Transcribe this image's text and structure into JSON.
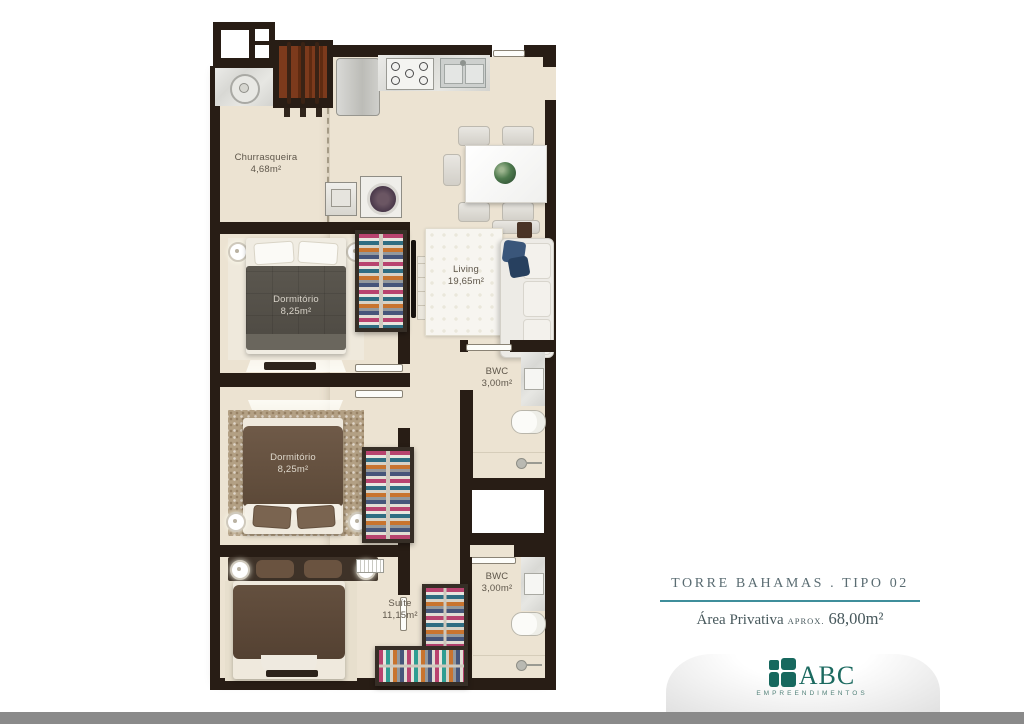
{
  "plan": {
    "rooms": {
      "churrasqueira": {
        "name": "Churrasqueira",
        "area": "4,68m²"
      },
      "living": {
        "name": "Living",
        "area": "19,65m²"
      },
      "dorm1": {
        "name": "Dormitório",
        "area": "8,25m²"
      },
      "dorm2": {
        "name": "Dormitório",
        "area": "8,25m²"
      },
      "bwc1": {
        "name": "BWC",
        "area": "3,00m²"
      },
      "bwc2": {
        "name": "BWC",
        "area": "3,00m²"
      },
      "suite": {
        "name": "Suíte",
        "area": "11,15m²"
      }
    }
  },
  "title_block": {
    "title": "TORRE BAHAMAS . TIPO 02",
    "area_label": "Área Privativa",
    "area_qualifier": "APROX.",
    "area_value": "68,00m²"
  },
  "logo": {
    "name": "ABC",
    "subtitle": "EMPREENDIMENTOS"
  },
  "colors": {
    "wall": "#281d15",
    "floor": "#ece3d2",
    "accent_teal": "#3f8e9b",
    "logo_teal": "#17685e",
    "footer_gray": "#8a8a8a"
  }
}
